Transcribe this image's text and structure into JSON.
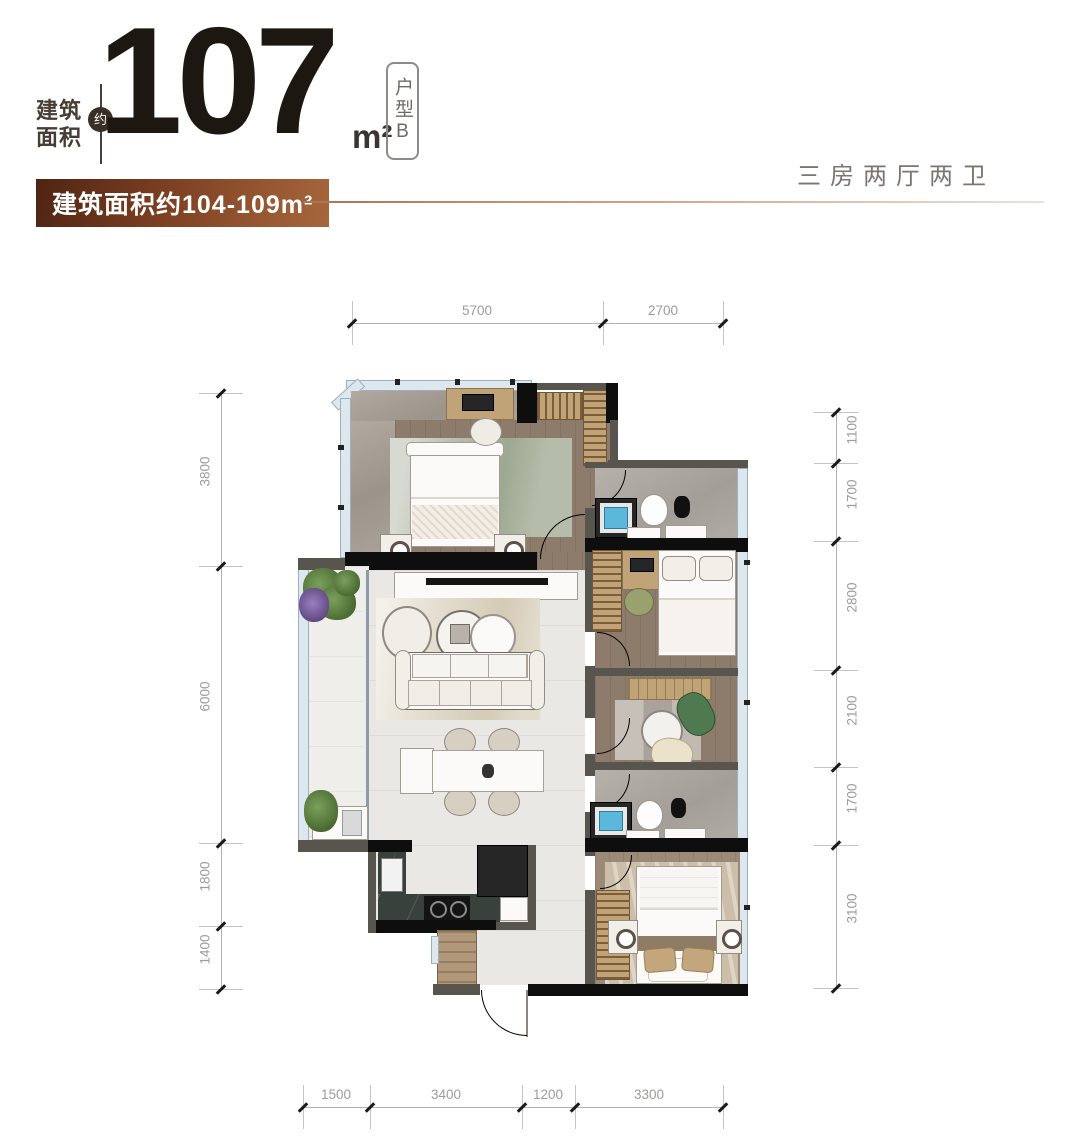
{
  "header": {
    "area_label_line1": "建筑",
    "area_label_line2": "面积",
    "approx_mark": "约",
    "area_number": "107",
    "area_unit": "m²",
    "unit_type": "户型B",
    "range_badge": "建筑面积约104-109m²",
    "layout_summary": "三房两厅两卫"
  },
  "colors": {
    "accent_brown_dark": "#4e2412",
    "accent_brown_light": "#a7673d",
    "number_ink": "#1d1712",
    "summary_gray": "#7c7672",
    "dimension_gray": "#9c9c9a",
    "wall_gray": "#57554d",
    "wall_black": "#0e0e0e",
    "window_blue": "#dde7ee",
    "basin_blue": "#5cb8da"
  },
  "floor_plan": {
    "dimensions": {
      "top": {
        "orientation": "h",
        "line": 323,
        "start": 352,
        "end": 723,
        "ticks": [
          352,
          603,
          723
        ],
        "segments": [
          {
            "label": "5700",
            "center": 477
          },
          {
            "label": "2700",
            "center": 663
          }
        ]
      },
      "bottom": {
        "orientation": "h",
        "line": 1107,
        "start": 303,
        "end": 723,
        "ticks": [
          303,
          370,
          522,
          575,
          723
        ],
        "segments": [
          {
            "label": "1500",
            "center": 336
          },
          {
            "label": "3400",
            "center": 446
          },
          {
            "label": "1200",
            "center": 548
          },
          {
            "label": "3300",
            "center": 649
          }
        ]
      },
      "left": {
        "orientation": "v",
        "line": 221,
        "start": 393,
        "end": 989,
        "ticks": [
          393,
          566,
          843,
          926,
          989
        ],
        "segments": [
          {
            "label": "3800",
            "center": 479
          },
          {
            "label": "6000",
            "center": 704
          },
          {
            "label": "1800",
            "center": 884
          },
          {
            "label": "1400",
            "center": 957
          }
        ]
      },
      "right": {
        "orientation": "v",
        "line": 836,
        "start": 412,
        "end": 988,
        "ticks": [
          412,
          463,
          541,
          670,
          767,
          845,
          988
        ],
        "segments": [
          {
            "label": "1100",
            "center": 437
          },
          {
            "label": "1700",
            "center": 502
          },
          {
            "label": "2800",
            "center": 605
          },
          {
            "label": "2100",
            "center": 718
          },
          {
            "label": "1700",
            "center": 806
          },
          {
            "label": "3100",
            "center": 916
          }
        ]
      }
    }
  }
}
